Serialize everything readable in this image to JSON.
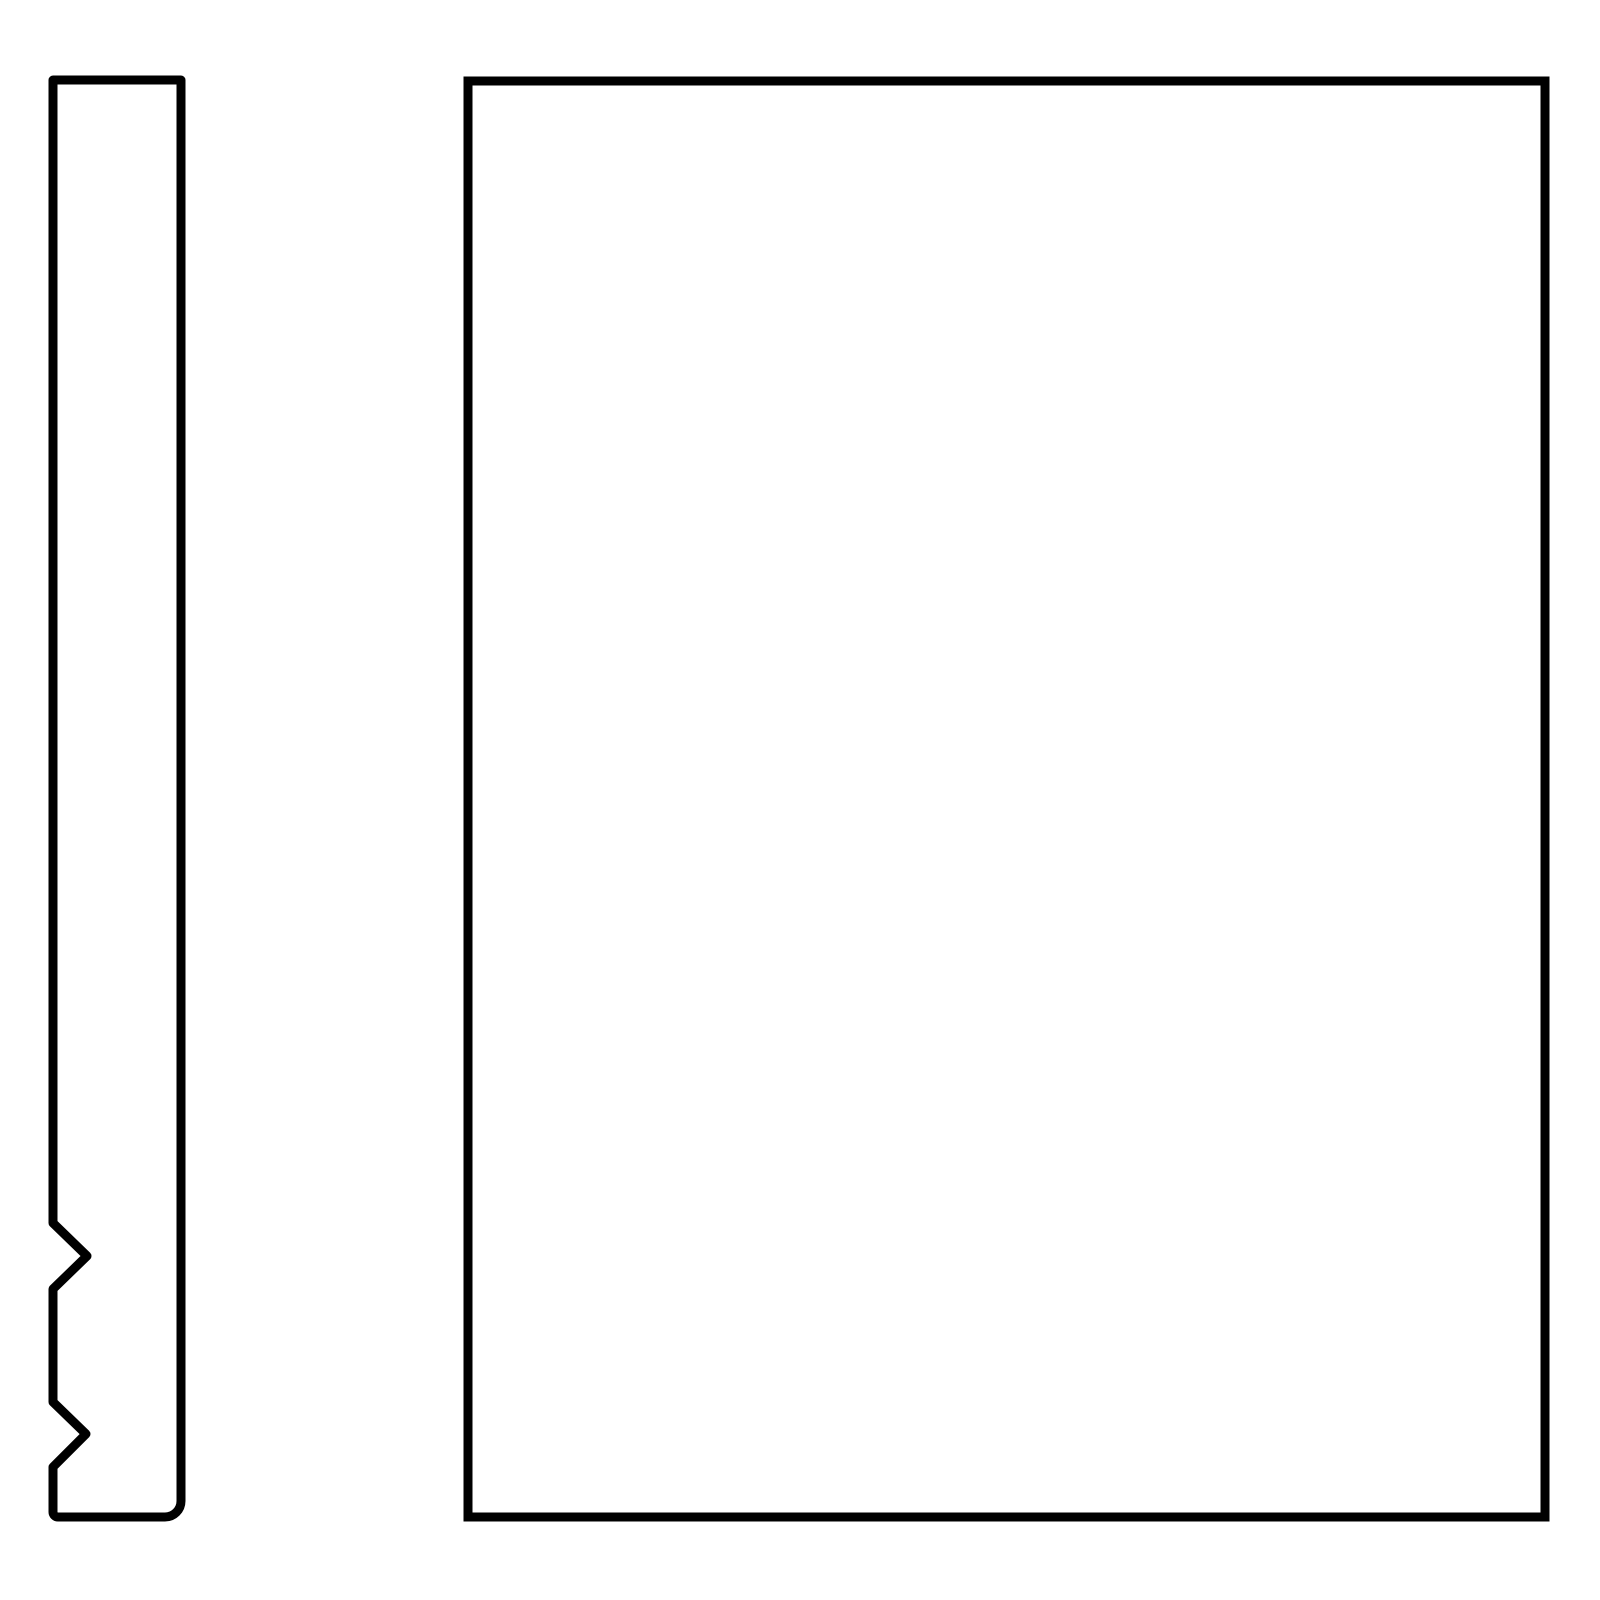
{
  "canvas": {
    "width": 1600,
    "height": 1600,
    "background_color": "#ffffff"
  },
  "drawing": {
    "stroke_color": "#000000",
    "stroke_width": 9,
    "fill_color": "none",
    "shapes": [
      {
        "name": "side-profile-outline",
        "kind": "closed-path",
        "features": "tall narrow board profile; two v-notches cut into left edge; rounded bottom-right corner; small rounded bottom-left corner",
        "path": "M 53 80 L 181 80 L 181 1501 A 16 16 0 0 1 165 1517 L 58 1517 A 5 5 0 0 1 53 1512 L 53 1467 L 86 1434 L 53 1402 L 53 1289 L 87 1256 L 53 1223 Z"
      },
      {
        "name": "front-panel-outline",
        "kind": "closed-path",
        "features": "large plain rectangle, sharp corners",
        "path": "M 468 81 L 1545 81 L 1545 1517 L 468 1517 Z"
      }
    ]
  }
}
